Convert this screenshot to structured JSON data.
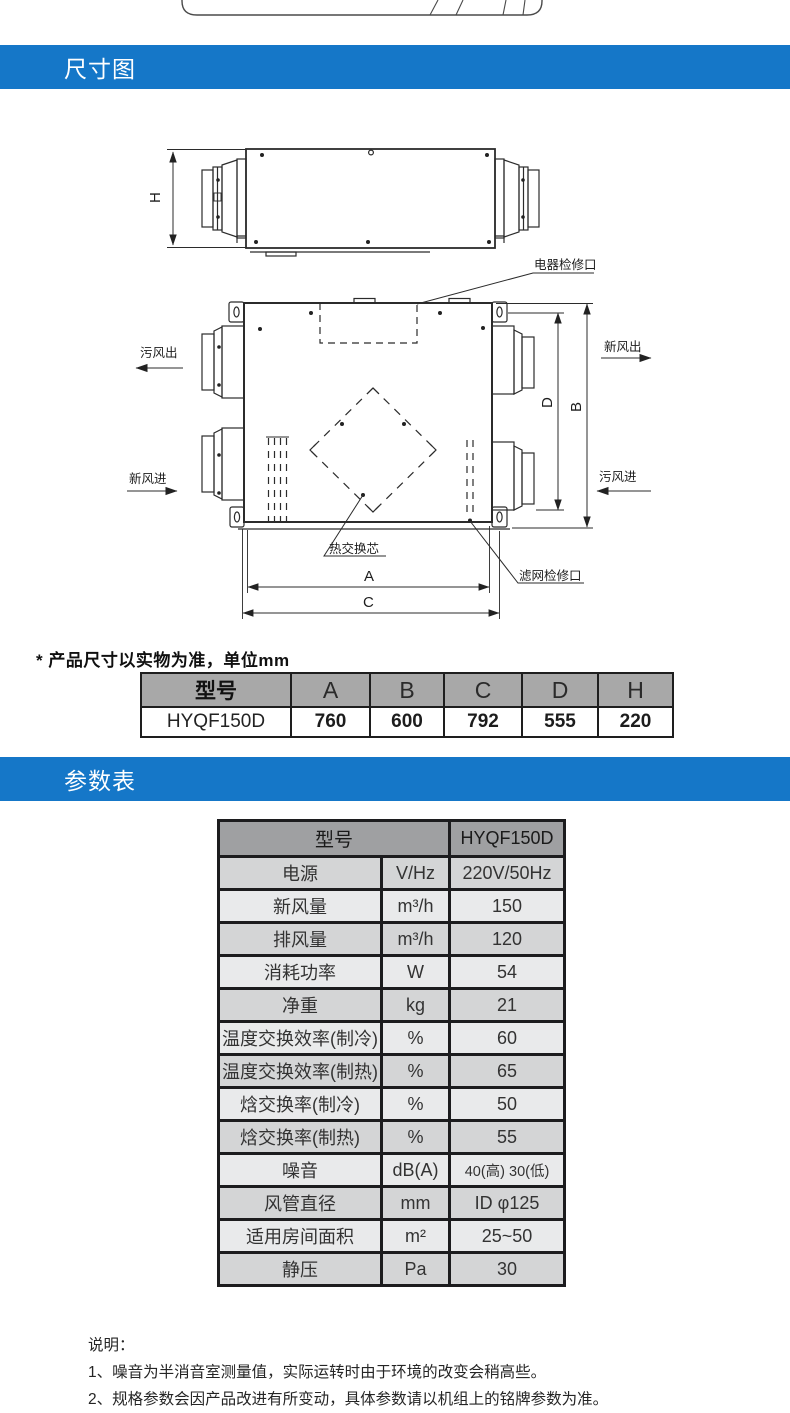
{
  "colors": {
    "accent_blue": "#1577c8",
    "table_header_grey": "#9fa0a2",
    "row_dark": "#d4d5d6",
    "row_light": "#e9eaeb"
  },
  "sections": {
    "dimensions": {
      "title": "尺寸图"
    },
    "parameters": {
      "title": "参数表"
    }
  },
  "diagram": {
    "labels": {
      "h": "H",
      "a": "A",
      "b": "B",
      "c": "C",
      "d": "D",
      "electrical_access": "电器检修口",
      "exhaust_air_out": "污风出",
      "fresh_air_out": "新风出",
      "fresh_air_in": "新风进",
      "exhaust_air_in": "污风进",
      "heat_exchange_core": "热交换芯",
      "filter_access": "滤网检修口"
    }
  },
  "size_note": "* 产品尺寸以实物为准，单位mm",
  "dimension_table": {
    "headers": [
      "型号",
      "A",
      "B",
      "C",
      "D",
      "H"
    ],
    "rows": [
      [
        "HYQF150D",
        "760",
        "600",
        "792",
        "555",
        "220"
      ]
    ]
  },
  "parameter_table": {
    "header": {
      "label": "型号",
      "value": "HYQF150D"
    },
    "rows": [
      {
        "label": "电源",
        "unit": "V/Hz",
        "value": "220V/50Hz"
      },
      {
        "label": "新风量",
        "unit": "m³/h",
        "value": "150"
      },
      {
        "label": "排风量",
        "unit": "m³/h",
        "value": "120"
      },
      {
        "label": "消耗功率",
        "unit": "W",
        "value": "54"
      },
      {
        "label": "净重",
        "unit": "kg",
        "value": "21"
      },
      {
        "label": "温度交换效率(制冷)",
        "unit": "%",
        "value": "60"
      },
      {
        "label": "温度交换效率(制热)",
        "unit": "%",
        "value": "65"
      },
      {
        "label": "焓交换率(制冷)",
        "unit": "%",
        "value": "50"
      },
      {
        "label": "焓交换率(制热)",
        "unit": "%",
        "value": "55"
      },
      {
        "label": "噪音",
        "unit": "dB(A)",
        "value": "40(高) 30(低)"
      },
      {
        "label": "风管直径",
        "unit": "mm",
        "value": "ID φ125"
      },
      {
        "label": "适用房间面积",
        "unit": "m²",
        "value": "25~50"
      },
      {
        "label": "静压",
        "unit": "Pa",
        "value": "30"
      }
    ]
  },
  "notes": {
    "title": "说明：",
    "items": [
      "1、噪音为半消音室测量值，实际运转时由于环境的改变会稍高些。",
      "2、规格参数会因产品改进有所变动，具体参数请以机组上的铭牌参数为准。"
    ]
  }
}
